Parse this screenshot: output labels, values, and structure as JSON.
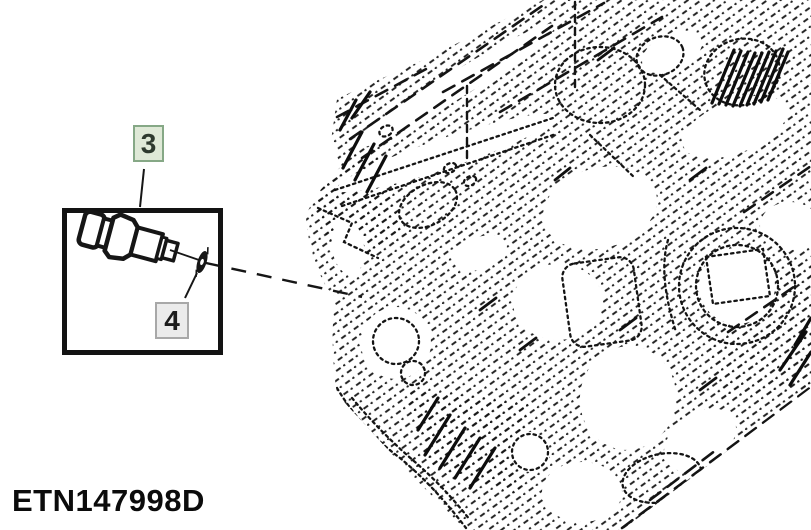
{
  "diagram": {
    "code": "ETN147998D",
    "labels": {
      "part3": "3",
      "part4": "4"
    },
    "art": {
      "engine_drawing": "engine-block-phantom-outline",
      "callout_box_contents": "sensor-with-sealing-washer"
    },
    "colors": {
      "background": "#ffffff",
      "line_art": "#161616",
      "label3_background": "#dfe9d7",
      "label3_border": "#86a886",
      "label3_text": "#2e3a2e",
      "label4_background": "#ebebeb",
      "label4_border": "#a8a8a8",
      "label4_text": "#1c1c1c"
    }
  }
}
